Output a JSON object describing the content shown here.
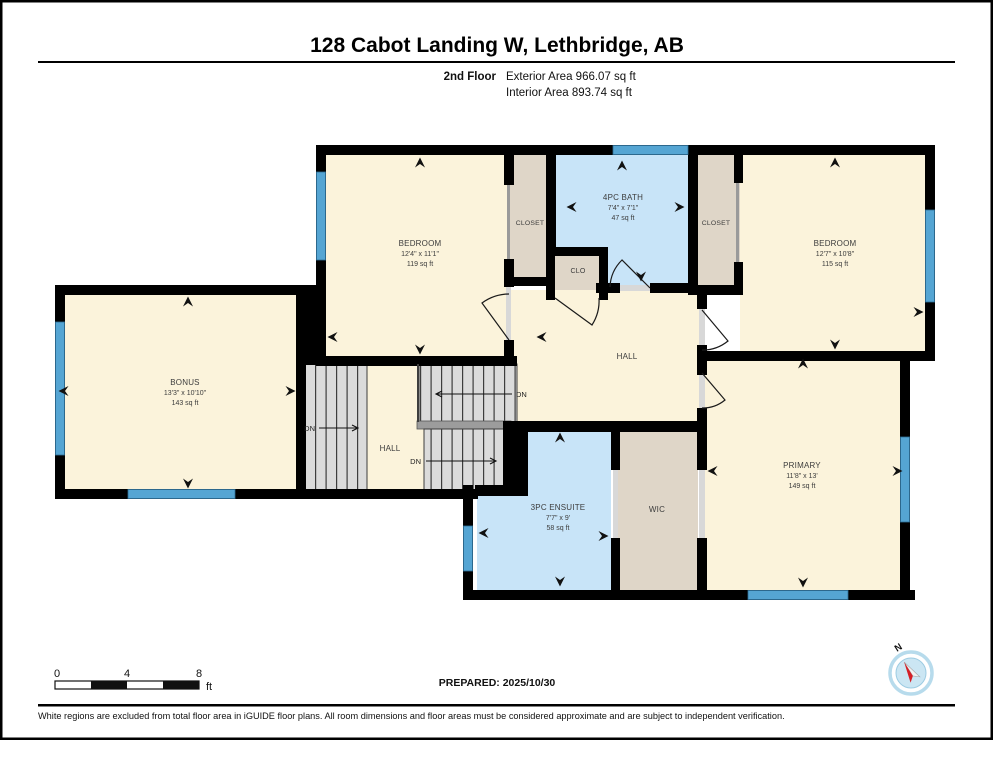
{
  "header": {
    "title": "128 Cabot Landing W, Lethbridge, AB",
    "floor_label": "2nd Floor",
    "exterior_area": "Exterior Area 966.07 sq ft",
    "interior_area": "Interior Area 893.74 sq ft"
  },
  "rooms": {
    "b1": {
      "name": "BEDROOM",
      "dims": "12'4\" x 11'1\"",
      "area": "119 sq ft"
    },
    "bath": {
      "name": "4PC BATH",
      "dims": "7'4\" x 7'1\"",
      "area": "47 sq ft"
    },
    "closet1": {
      "name": "CLOSET"
    },
    "clo": {
      "name": "CLO"
    },
    "closet2": {
      "name": "CLOSET"
    },
    "b2": {
      "name": "BEDROOM",
      "dims": "12'7\" x 10'8\"",
      "area": "115 sq ft"
    },
    "bonus": {
      "name": "BONUS",
      "dims": "13'3\" x 10'10\"",
      "area": "143 sq ft"
    },
    "hall": {
      "name": "HALL"
    },
    "hall2": {
      "name": "HALL"
    },
    "primary": {
      "name": "PRIMARY",
      "dims": "11'8\" x 13'",
      "area": "149 sq ft"
    },
    "ensuite": {
      "name": "3PC ENSUITE",
      "dims": "7'7\" x 9'",
      "area": "58 sq ft"
    },
    "wic": {
      "name": "WIC"
    }
  },
  "stairs": {
    "dn1": "DN",
    "dn2": "DN",
    "dn3": "DN"
  },
  "scale_bar": {
    "t0": "0",
    "t4": "4",
    "t8": "8",
    "unit": "ft"
  },
  "compass": {
    "north_label": "N"
  },
  "footer": {
    "prepared": "PREPARED: 2025/10/30",
    "disclaimer": "White regions are excluded from total floor area in iGUIDE floor plans. All room dimensions and floor areas must be considered approximate and are subject to independent verification."
  },
  "colors": {
    "room_fill": "#FBF3DB",
    "wet_room_fill": "#C8E4F8",
    "closet_fill": "#DFD6C8",
    "window_blue": "#55A5D3",
    "stairs_gray": "#DBDBDB",
    "wall_black": "#000000"
  }
}
